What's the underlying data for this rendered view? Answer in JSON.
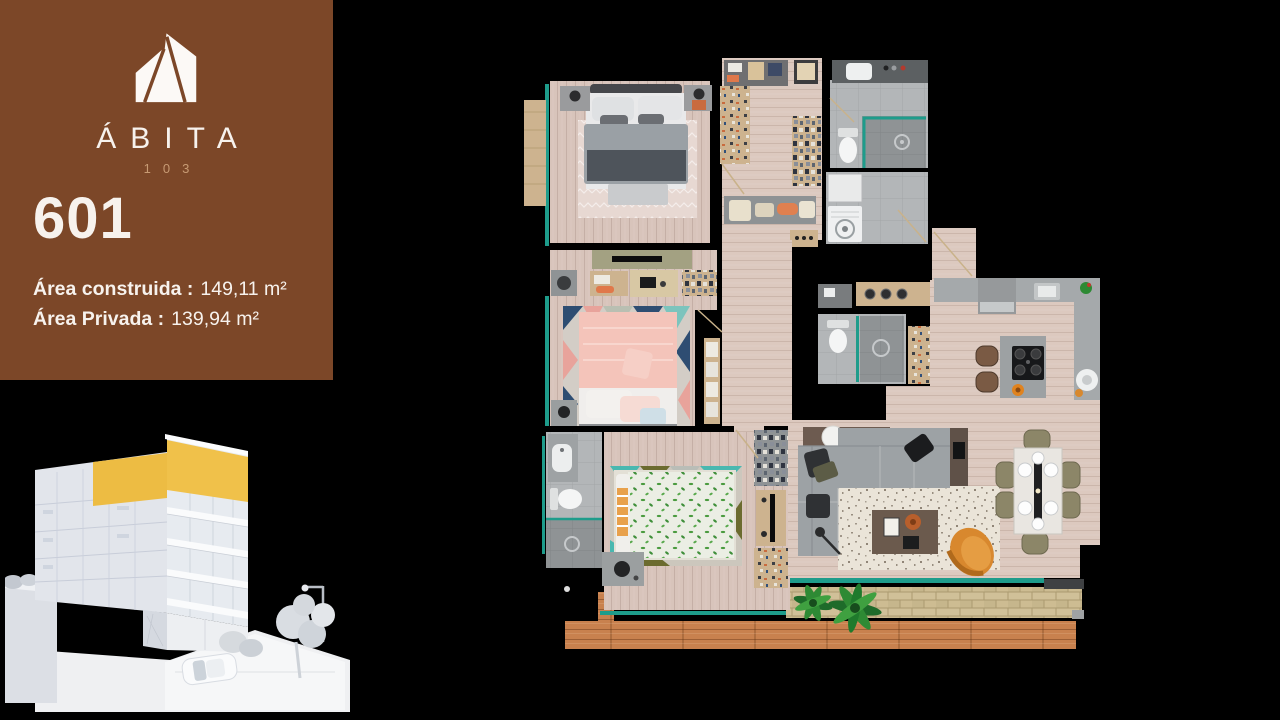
{
  "page": {
    "background": "#000000"
  },
  "brand_panel": {
    "logo_icon": "house-logo-icon",
    "brand_name": "ÁBITA",
    "project_number": "103",
    "unit_number": "601",
    "area_built_label": "Área construida :",
    "area_built_value": "149,11 m²",
    "area_private_label": "Área Privada :",
    "area_private_value": "139,94 m²"
  },
  "colors": {
    "page-bg": "#000000",
    "panel-brown": "#7C4728",
    "brand-tan": "#C79A73",
    "text-light": "#F7F2ED",
    "highlight-yellow": "#F0C14A",
    "window-teal": "#1E9C8B",
    "wood-floor": "#D8C4BB",
    "wood-floor-light": "#DCC9BF",
    "deck-wood": "#C8814E",
    "brick-tan": "#C9B88D",
    "tile-light": "#B3B6B8",
    "tile-dark": "#8F9395",
    "counter-gray": "#A5A9AB",
    "sofa-gray": "#9DA2A5",
    "closet-tan": "#CDB38F",
    "accent-orange": "#D8882E",
    "bed-pink": "#F4C4BA",
    "plant-green": "#2E8A34",
    "building-face": "#E2E5EB",
    "building-side": "#F3F5F7"
  }
}
